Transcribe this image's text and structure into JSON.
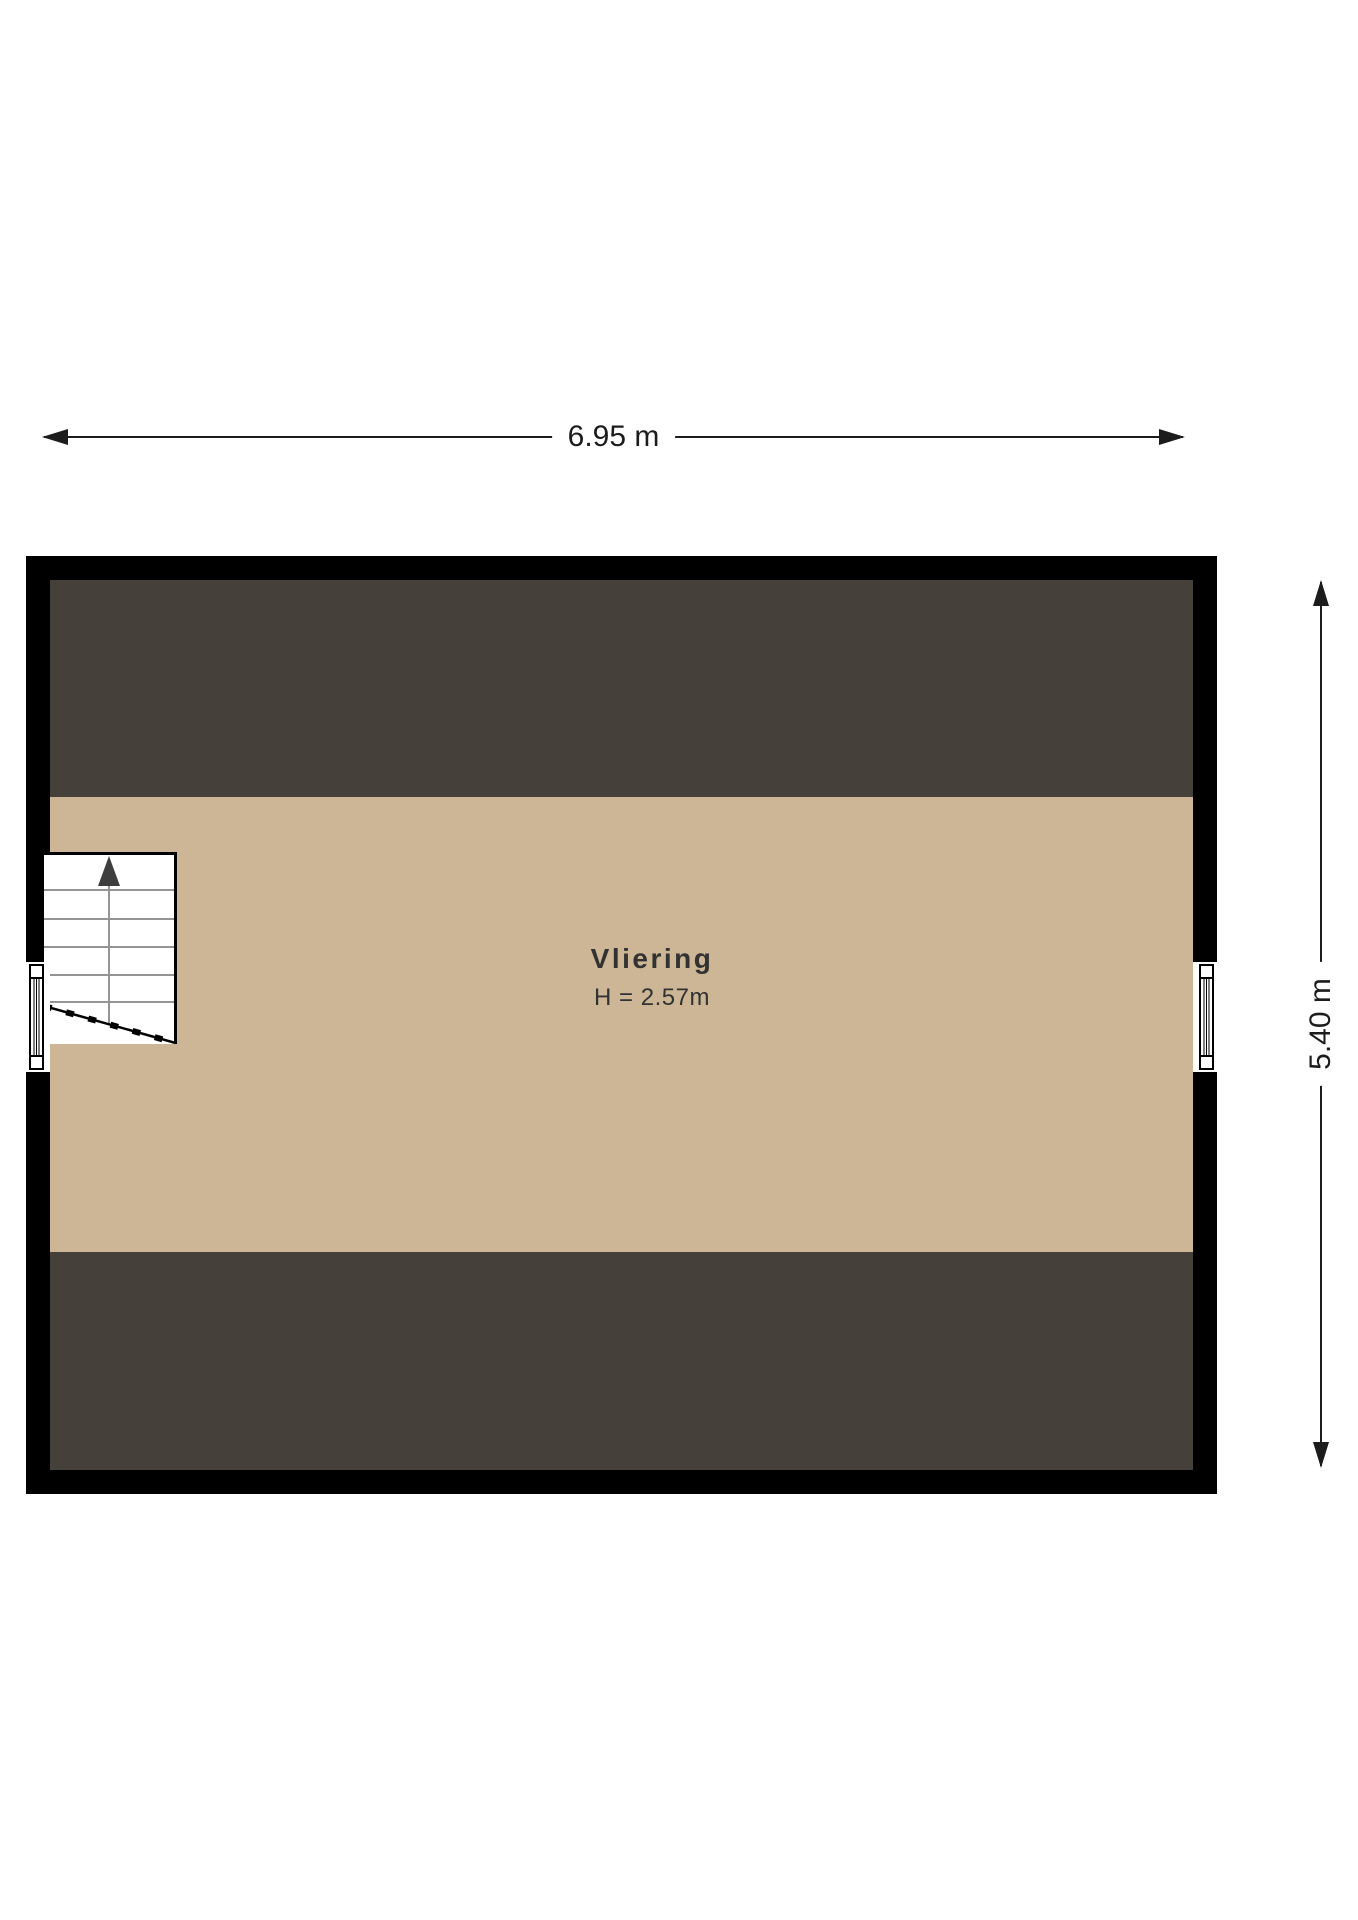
{
  "floorplan": {
    "room": {
      "name": "Vliering",
      "height_label": "H = 2.57m"
    },
    "dimensions": {
      "width_label": "6.95 m",
      "height_label": "5.40 m"
    },
    "colors": {
      "background": "#ffffff",
      "wall": "#000000",
      "sloped_area": "#45413a",
      "floor": "#cdb695",
      "stair_step_line": "#949494",
      "stair_arrow": "#3e3e3e",
      "dimension": "#1c1c1c",
      "room_text": "#323232"
    },
    "icons": {
      "stairs_up_arrow": "▲",
      "dimension_arrow_left": "◀",
      "dimension_arrow_right": "▶"
    }
  }
}
